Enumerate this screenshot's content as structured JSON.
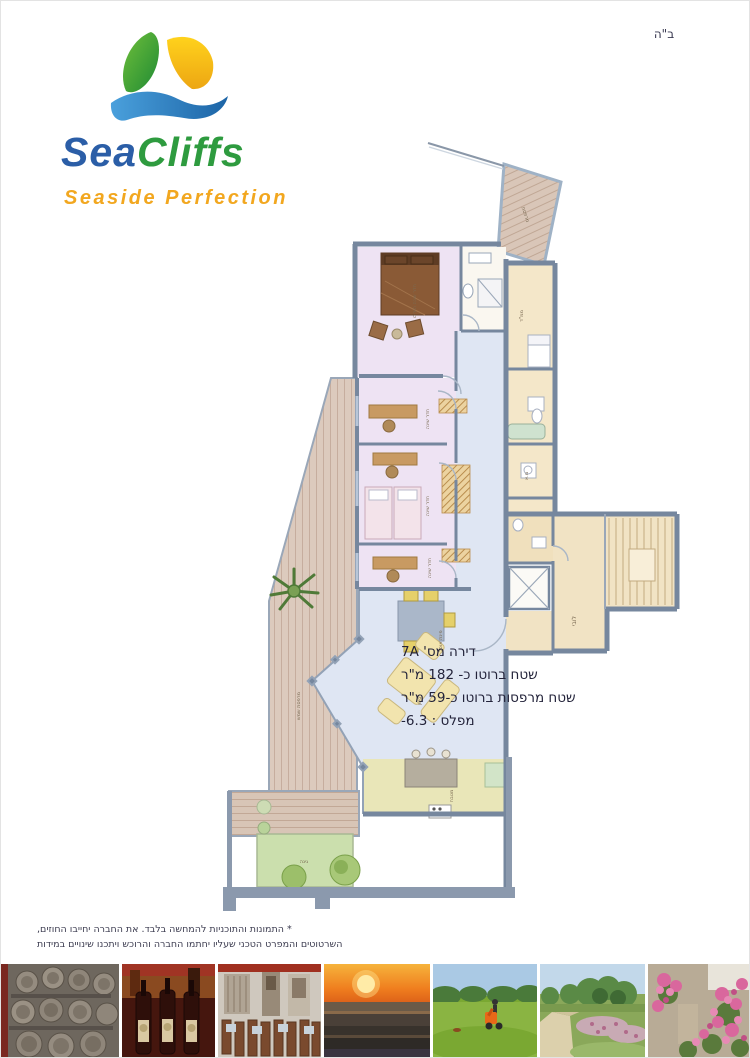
{
  "page": {
    "bh": "ב\"ה"
  },
  "logo": {
    "name_sea": "Sea",
    "name_cliffs": "Cliffs",
    "tagline": "Seaside Perfection"
  },
  "apartment": {
    "line1": "דירה מס' 7A",
    "line2": "שטח ברוטו כ- 182 מ\"ר",
    "line3": "שטח מרפסות ברוטו כ-59 מ\"ר",
    "line4": "מפלס : 6.3-"
  },
  "disclaimer": {
    "line1": "* התמונות והתוכניות להמחשה בלבד. את החברה יחייבו החוזים,",
    "line2": "השרטוטים והמפרט הטכני שעליו יחתמו החברה והרוכש ויתכנו שינויים במידות"
  },
  "floorplan": {
    "labels": {
      "master": "חדר שינה הורים",
      "bedroom": "חדר שינה",
      "mamad": "ממ\"ד",
      "dining": "פינת אוכל",
      "living": "סלון",
      "kitchen": "מטבח",
      "laundry": "מ.א",
      "lobby": "לובי",
      "deck": "מרפסת שמש",
      "garden": "גינה",
      "balcony": "מרפסת"
    }
  },
  "photos": [
    {
      "name": "wine-barrels"
    },
    {
      "name": "wine-bottles"
    },
    {
      "name": "restaurant"
    },
    {
      "name": "sea-sunset"
    },
    {
      "name": "golf-course"
    },
    {
      "name": "garden-path"
    },
    {
      "name": "pink-flowers"
    }
  ],
  "colors": {
    "logo_blue": "#2b5ea7",
    "logo_green": "#2e9b3f",
    "logo_orange": "#f2a71f",
    "wall": "#76879e",
    "floor_pink": "#eee3f3",
    "floor_blue": "#dfe6f3",
    "floor_cream": "#f4e7c9",
    "floor_kitchen": "#e9e6b8",
    "deck_wood": "#dccabd",
    "garden_green": "#cbdfad"
  }
}
